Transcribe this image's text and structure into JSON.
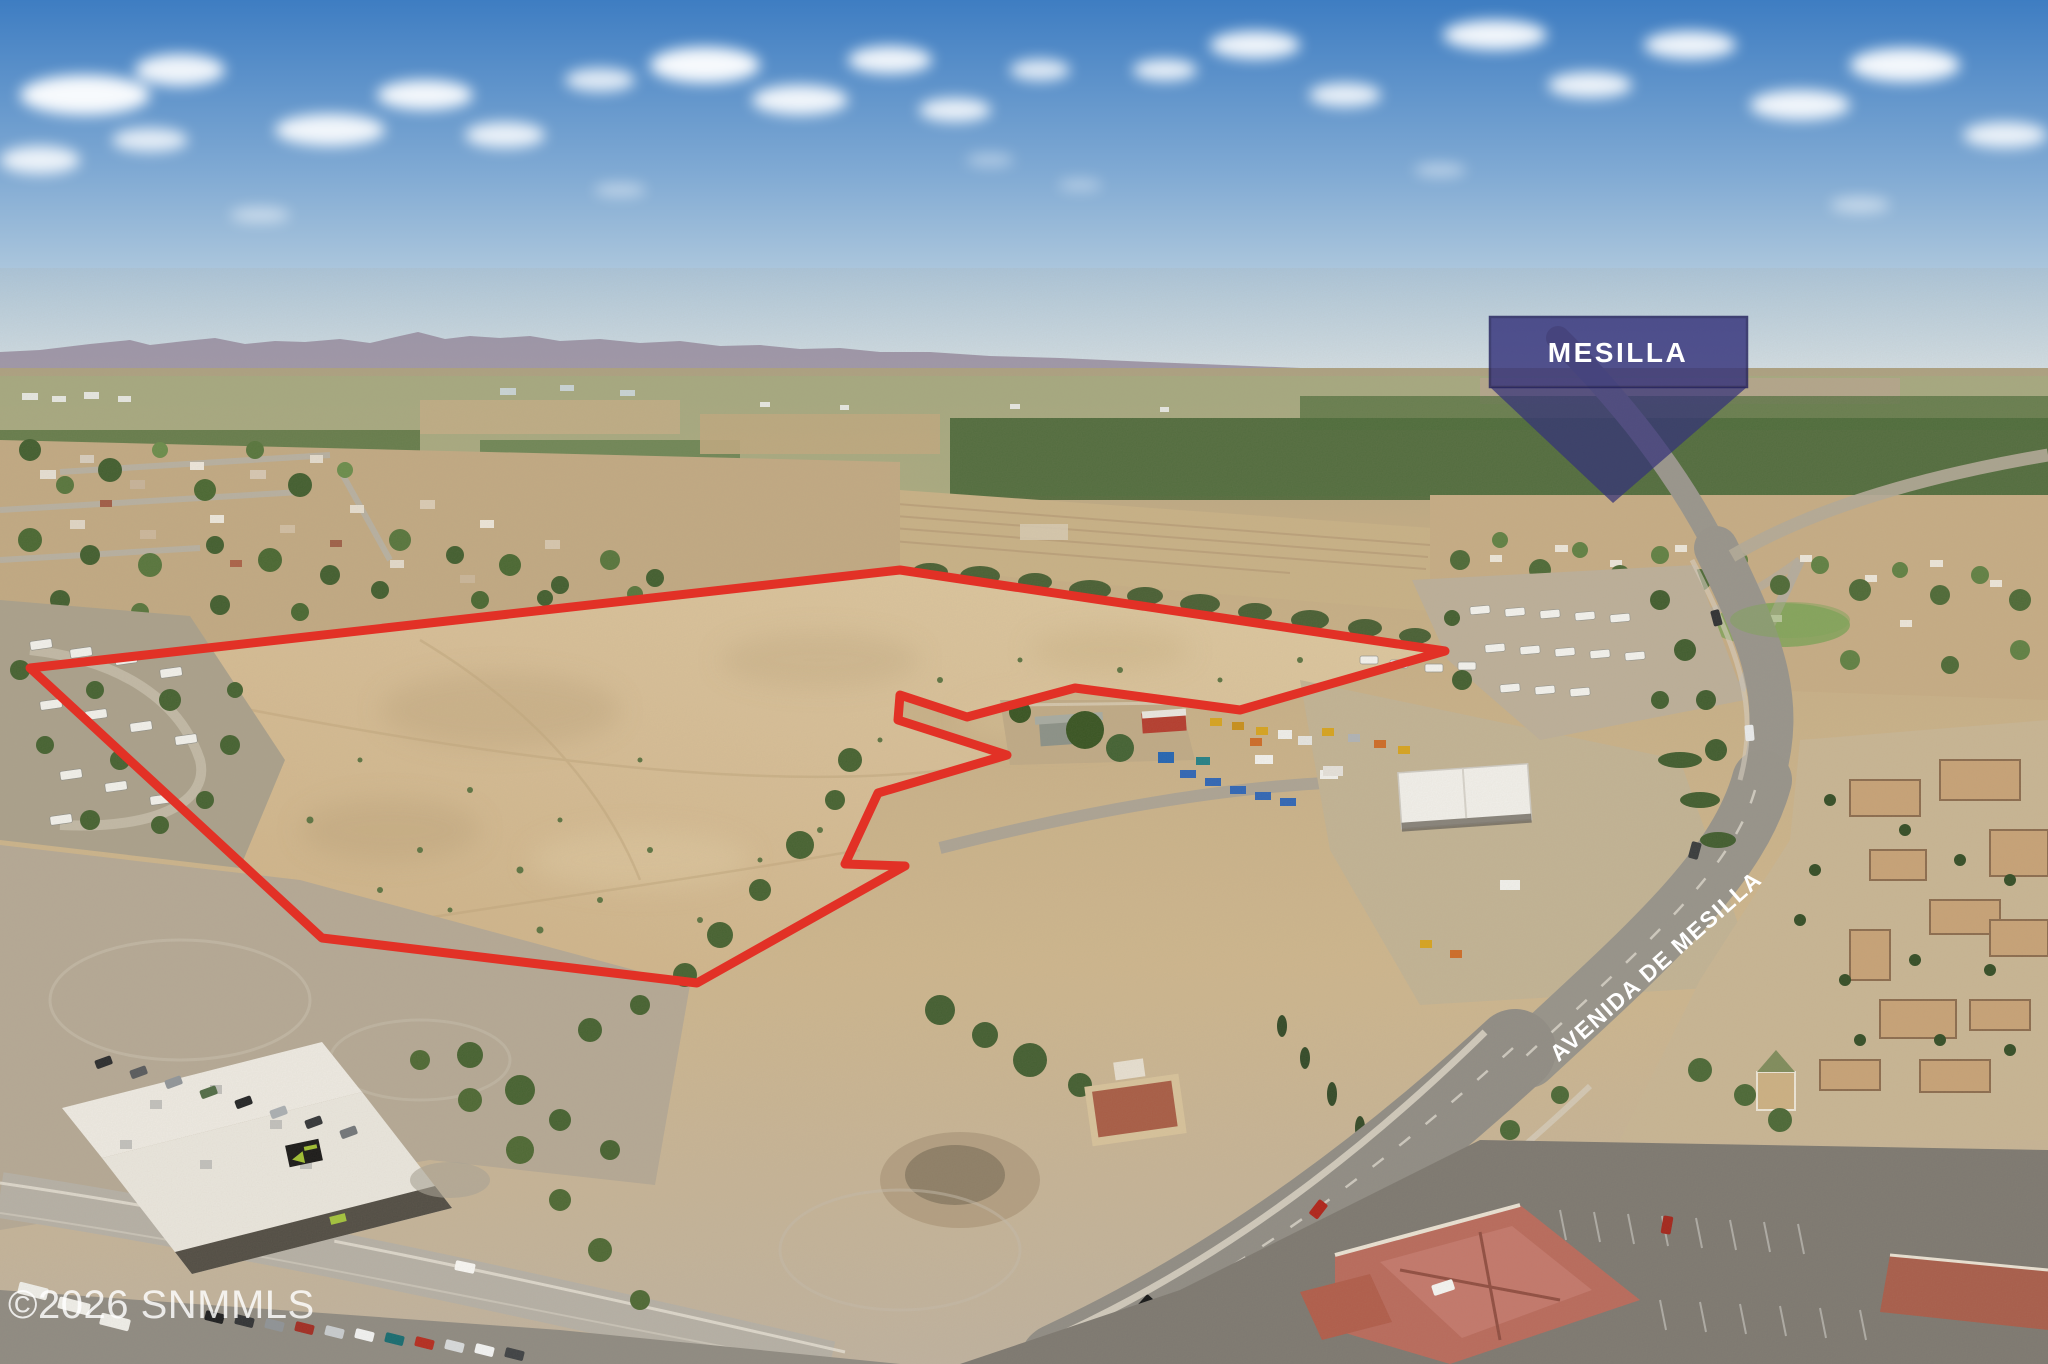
{
  "scene": {
    "kind": "aerial-drone-photograph",
    "subject": "vacant land parcel outlined in red near Mesilla NM"
  },
  "overlays": {
    "callout": {
      "label": "MESILLA",
      "fill": "#34327a",
      "fill_opacity": "0.78",
      "border": "#23215c",
      "text_color": "#ffffff"
    },
    "street_label": {
      "text": "AVENIDA DE MESILLA",
      "color": "#ffffff"
    },
    "watermark": {
      "text": "©2026 SNMMLS",
      "color": "#ffffff"
    },
    "parcel_outline": {
      "color": "#e23126",
      "stroke_width": "9"
    }
  },
  "palette": {
    "sky_top": "#3e7dc2",
    "sky_horizon": "#d7e2e8",
    "parcel_dirt": "#d8bf97",
    "road_asphalt": "#97948c",
    "orchard_green": "#3f6030",
    "mountain_haze": "#91849b"
  }
}
